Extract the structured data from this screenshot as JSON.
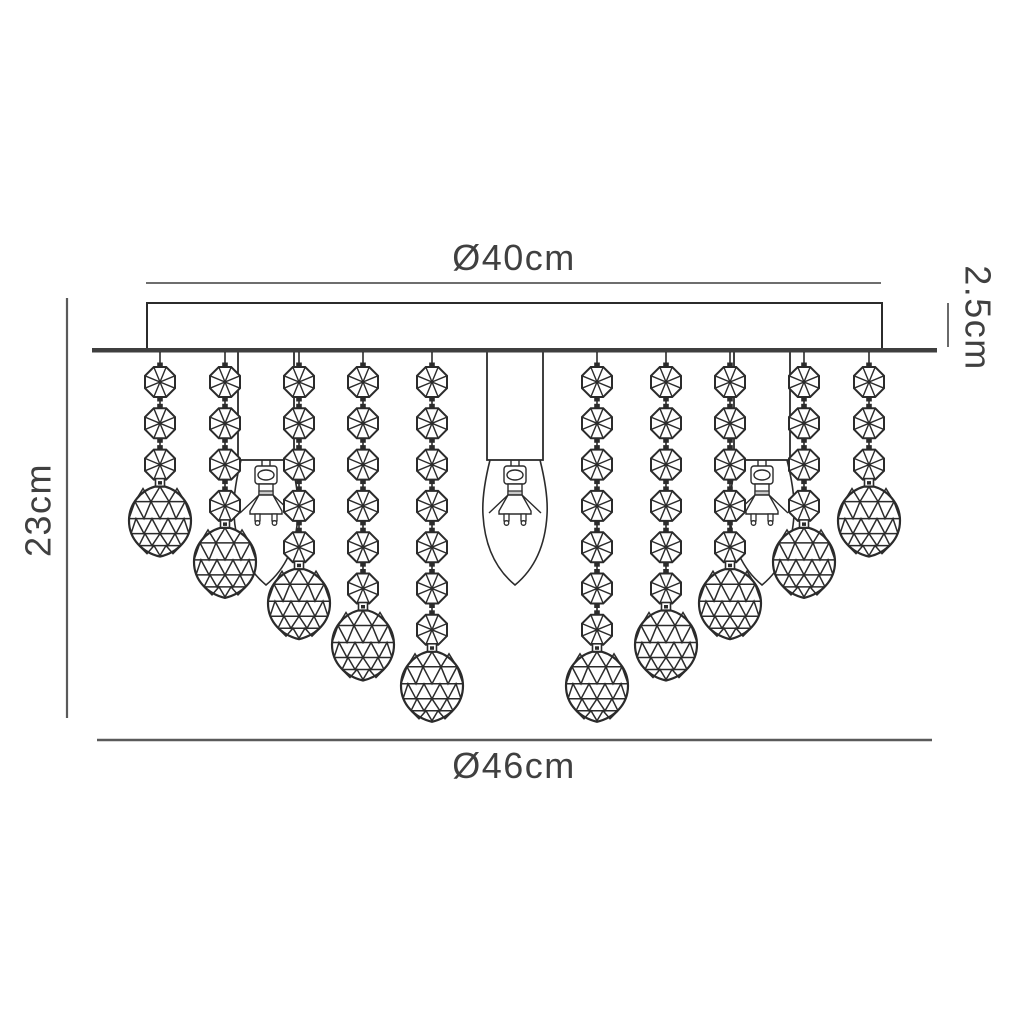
{
  "diagram": {
    "type": "product-dimension-drawing",
    "subject": "flush ceiling light with crystal bead strands and candle bulbs",
    "dimensions": {
      "top_diameter": "Ø40cm",
      "canopy_height": "2.5cm",
      "overall_height": "23cm",
      "bottom_diameter": "Ø46cm"
    },
    "colors": {
      "line": "#2b2b2b",
      "dimension": "#5a5a5a",
      "text": "#404040",
      "plate": "#3f3f3f",
      "background": "#ffffff"
    },
    "strands": [
      {
        "x": 160,
        "beads": 3
      },
      {
        "x": 225,
        "beads": 4
      },
      {
        "x": 299,
        "beads": 5
      },
      {
        "x": 363,
        "beads": 6
      },
      {
        "x": 432,
        "beads": 7
      },
      {
        "x": 597,
        "beads": 7
      },
      {
        "x": 666,
        "beads": 6
      },
      {
        "x": 730,
        "beads": 5
      },
      {
        "x": 804,
        "beads": 4
      },
      {
        "x": 869,
        "beads": 3
      }
    ],
    "bulbs": [
      {
        "x": 266
      },
      {
        "x": 515
      },
      {
        "x": 762
      }
    ]
  }
}
